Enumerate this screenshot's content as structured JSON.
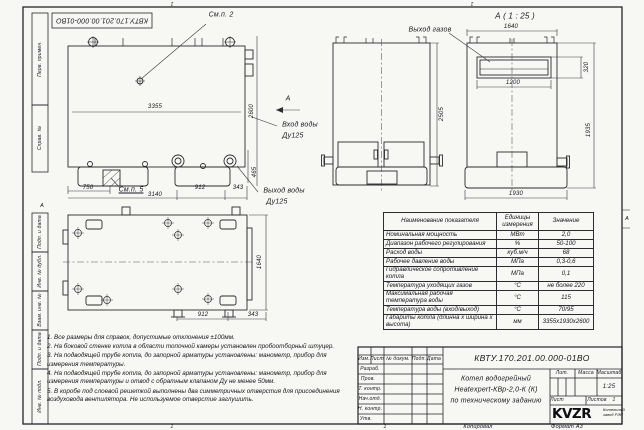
{
  "frame": {
    "designation": "КВТУ.170.201.00.000-01ВО",
    "zone_top": "1",
    "zone_bottom": "1",
    "zone_right": "А",
    "margin_labels": [
      "Перв. примен.",
      "Справ. №",
      "Подп. и дата",
      "Инв. № дубл.",
      "Взам. инв. №",
      "Подп. и дата",
      "Инв. № подл."
    ]
  },
  "views": {
    "side": {
      "callout_top": "См.п. 2",
      "callout_bottom": "См.п. 5",
      "dim_length": "3355",
      "dim_height": "2600",
      "dim_750": "750",
      "dim_3140": "3140",
      "dim_912": "912",
      "dim_343": "343",
      "dim_465": "465",
      "section_label": "А",
      "inlet_line1": "Вход воды",
      "inlet_line2": "Ду125",
      "outlet_line1": "Выход воды",
      "outlet_line2": "Ду125"
    },
    "front": {
      "dim_height": "2505"
    },
    "section_a": {
      "title": "А ( 1 : 25 )",
      "gas_outlet": "Выход газов",
      "dim_width": "1640",
      "dim_slot": "1200",
      "dim_320": "320",
      "dim_height": "1935",
      "dim_base": "1930"
    },
    "plan": {
      "dim_width": "1640",
      "dim_912": "912",
      "dim_343": "343",
      "section_label": "А"
    }
  },
  "table": {
    "headers": [
      "Наименование показателя",
      "Единицы измерения",
      "Значение"
    ],
    "rows": [
      {
        "name": "Номинальная мощность",
        "unit": "МВт",
        "value": "2,0"
      },
      {
        "name": "Диапазон рабочего регулирования",
        "unit": "%",
        "value": "50-100"
      },
      {
        "name": "Расход воды",
        "unit": "куб.м/ч",
        "value": "68"
      },
      {
        "name": "Рабочее давление воды",
        "unit": "МПа",
        "value": "0,3-0,6"
      },
      {
        "name": "Гидравлическое сопротивление котла",
        "unit": "МПа",
        "value": "0,1"
      },
      {
        "name": "Температура уходящих газов",
        "unit": "°С",
        "value": "не более 220"
      },
      {
        "name": "Максимальная рабочая температура воды",
        "unit": "°С",
        "value": "115"
      },
      {
        "name": "Температура воды (вход/выход)",
        "unit": "°С",
        "value": "70/95"
      },
      {
        "name": "Габариты котла (длинна х ширина х высота)",
        "unit": "мм",
        "value": "3355х1930х2600"
      }
    ]
  },
  "notes": [
    "1. Все размеры для справок, допустимые отклонения ±100мм.",
    "2. На боковой стенке котла в области топочной камеры установлен пробоотборный штуцер.",
    "3. На подводящей трубе котла, до запорной арматуры установлены: манометр, прибор для измерения температуры.",
    "4. На подводящей трубе котла, до запорной арматуры установлены: манометр, прибор для измерения температуры и отвод с обратным клапаном Ду не менее 50мм.",
    "5. В коробе под слоевой решеткой выполнены два симметричных отверстия для присоединения воздуховода вентилятора. Не используемое отверстие заглушить."
  ],
  "title_block": {
    "designation": "КВТУ.170.201.00.000-01ВО",
    "name_line1": "Котел водогрейный",
    "name_line2": "Heatexpert-КВр-2,0-К (К)",
    "name_line3": "по техническому заданию",
    "col_izm": "Изм.",
    "col_list": "Лист",
    "col_docnum": "№ докум.",
    "col_podp": "Подп.",
    "col_data": "Дата",
    "rows": [
      "Разраб.",
      "Пров.",
      "Т. контр.",
      "Нач.отд.",
      "Н. контр.",
      "Утв."
    ],
    "lit_label": "Лит.",
    "massa_label": "Масса",
    "masshtab_label": "Масштаб",
    "masshtab_value": "1:25",
    "list_label": "Лист",
    "listov_label": "Листов",
    "listov_value": "1",
    "logo_text": "KVZR",
    "logo_caption_line1": "Котельный",
    "logo_caption_line2": "завод РЭП",
    "kopiroval": "Копировал",
    "format": "Формат А3",
    "zone": "1"
  }
}
